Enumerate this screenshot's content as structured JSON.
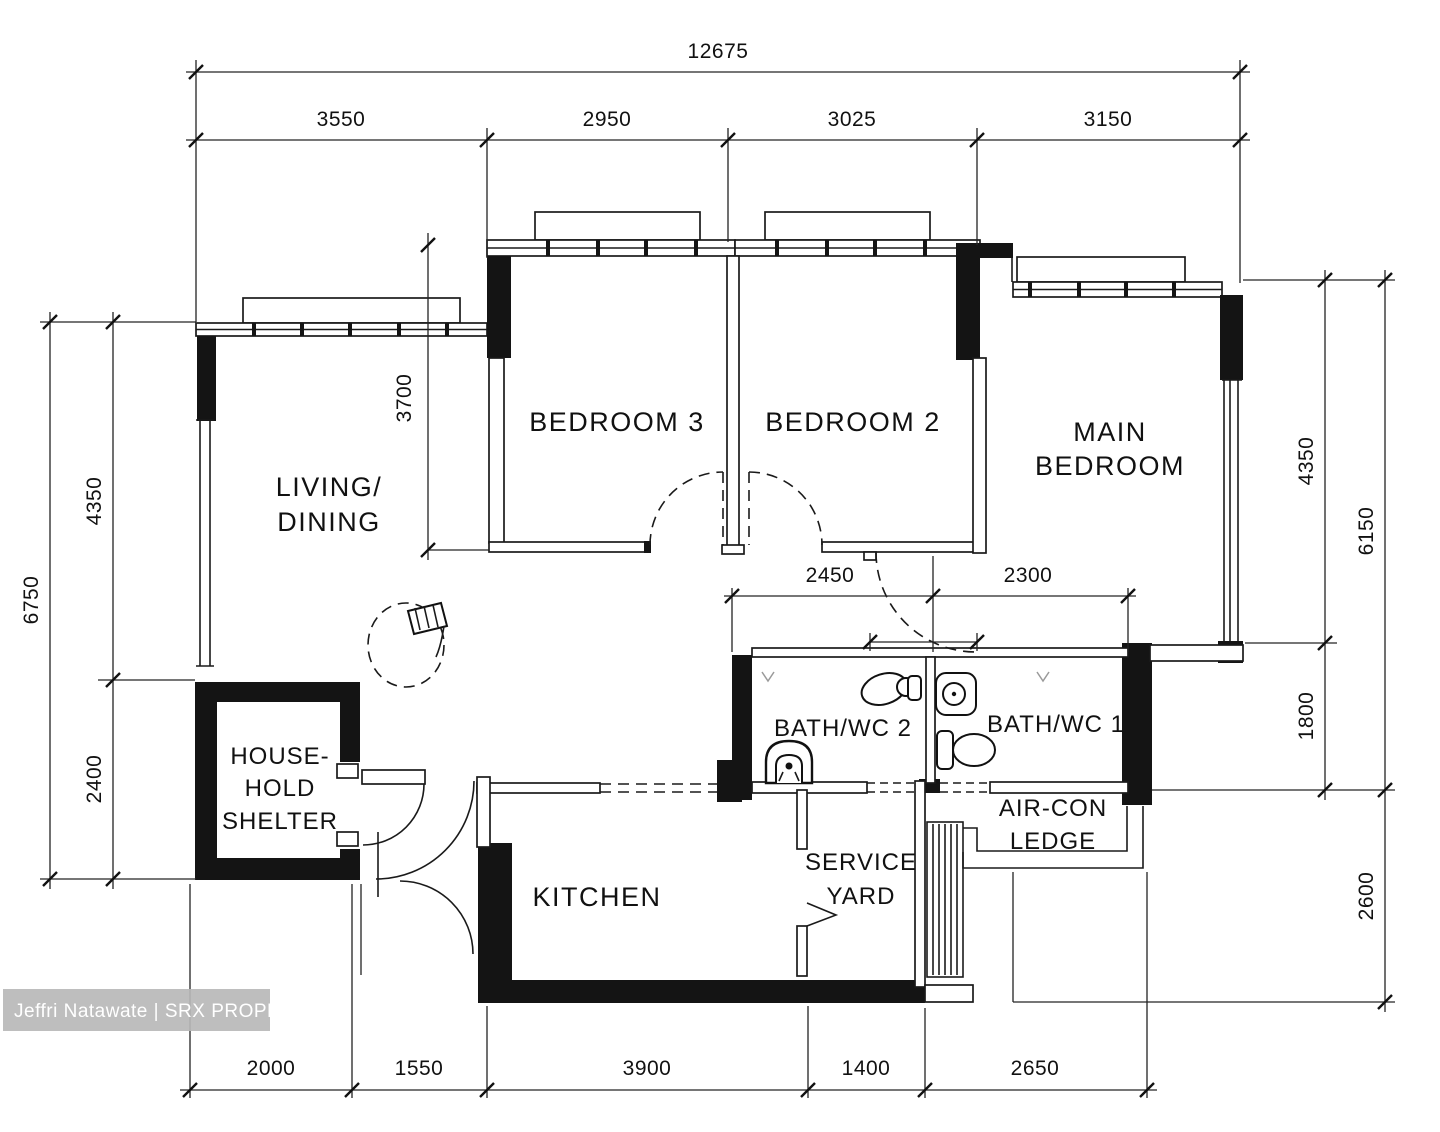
{
  "watermark": {
    "text": "Jeffri Natawate | SRX PROPERTY"
  },
  "rooms": {
    "living_dining": {
      "line1": "LIVING/",
      "line2": "DINING"
    },
    "bedroom3": {
      "label": "BEDROOM 3"
    },
    "bedroom2": {
      "label": "BEDROOM 2"
    },
    "main_bedroom": {
      "line1": "MAIN",
      "line2": "BEDROOM"
    },
    "household_shelter": {
      "line1": "HOUSE-",
      "line2": "HOLD",
      "line3": "SHELTER"
    },
    "bath2": {
      "label": "BATH/WC 2"
    },
    "bath1": {
      "label": "BATH/WC 1"
    },
    "kitchen": {
      "label": "KITCHEN"
    },
    "service_yard": {
      "line1": "SERVICE",
      "line2": "YARD"
    },
    "aircon_ledge": {
      "line1": "AIR-CON",
      "line2": "LEDGE"
    }
  },
  "dims": {
    "top_overall": "12675",
    "top_1": "3550",
    "top_2": "2950",
    "top_3": "3025",
    "top_4": "3150",
    "left_overall": "6750",
    "left_1": "4350",
    "left_2": "2400",
    "right_1": "4350",
    "right_2": "1800",
    "right_overall": "6150",
    "right_3": "2600",
    "bottom_1": "2000",
    "bottom_2": "1550",
    "bottom_3": "3900",
    "bottom_4": "1400",
    "bottom_5": "2650",
    "bed3_depth": "3700",
    "bath2_w": "2450",
    "bath1_w": "2300"
  },
  "colors": {
    "line": "#1a1a1a",
    "wall": "#141414",
    "watermark_bg": "#b9b9b9",
    "watermark_text": "#ffffff"
  }
}
